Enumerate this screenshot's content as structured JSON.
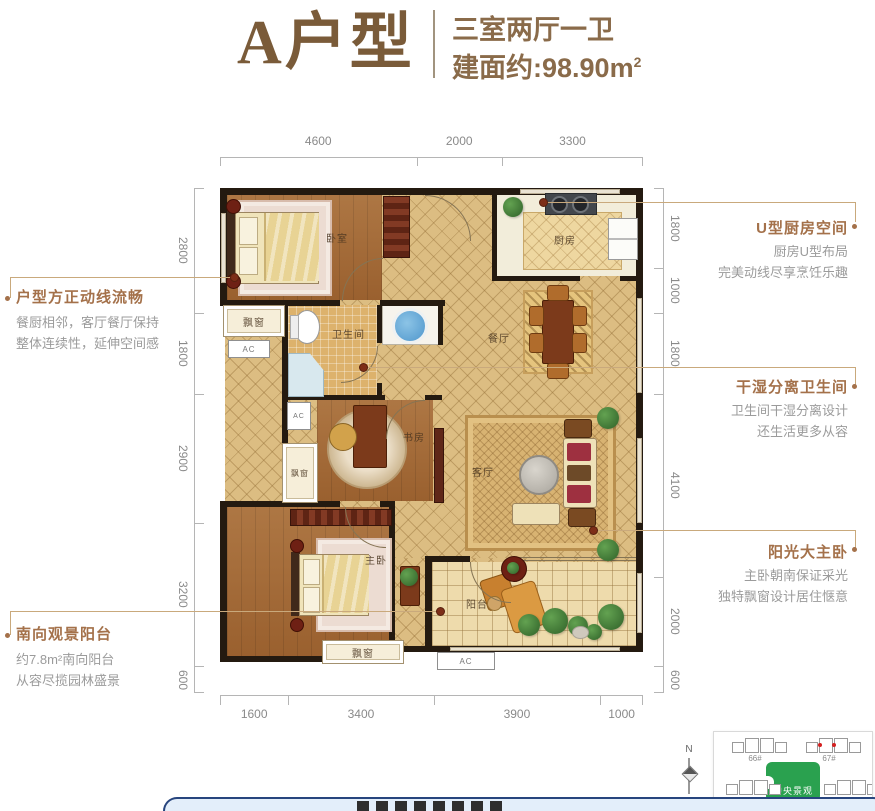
{
  "header": {
    "unit": "A户型",
    "layout": "三室两厅一卫",
    "area_label": "建面约:",
    "area_value": "98.90m",
    "area_sup": "2"
  },
  "dimensions": {
    "top": [
      "4600",
      "2000",
      "3300"
    ],
    "bottom": [
      "1600",
      "3400",
      "3900",
      "1000"
    ],
    "left": [
      "2800",
      "1800",
      "2900",
      "3200",
      "600"
    ],
    "right": [
      "1800",
      "1000",
      "1800",
      "4100",
      "2000",
      "600"
    ]
  },
  "annotations": {
    "left": [
      {
        "title": "户型方正动线流畅",
        "line1": "餐厨相邻，客厅餐厅保持",
        "line2": "整体连续性，延伸空间感"
      },
      {
        "title": "南向观景阳台",
        "line1": "约7.8m²南向阳台",
        "line2": "从容尽揽园林盛景"
      }
    ],
    "right": [
      {
        "title": "U型厨房空间",
        "line1": "厨房U型布局",
        "line2": "完美动线尽享烹饪乐趣"
      },
      {
        "title": "干湿分离卫生间",
        "line1": "卫生间干湿分离设计",
        "line2": "还生活更多从容"
      },
      {
        "title": "阳光大主卧",
        "line1": "主卧朝南保证采光",
        "line2": "独特飘窗设计居住惬意"
      }
    ]
  },
  "rooms": {
    "bedroom": "卧室",
    "kitchen": "厨房",
    "bathroom": "卫生间",
    "dining": "餐厅",
    "study": "书房",
    "living": "客厅",
    "master": "主卧",
    "balcony": "阳台",
    "bay_window": "飘窗",
    "ac": "AC"
  },
  "site_plan": {
    "building_66": "66#",
    "building_67": "67#",
    "center": "中央景观"
  },
  "compass": {
    "label": "N"
  },
  "colors": {
    "accent": "#a4714a",
    "leader": "#c9a97c",
    "wall": "#241a10",
    "header_brown": "#8a6b4a",
    "serif_brown": "#7a5b39",
    "dim_text": "#8a8a8a",
    "dim_line": "#b5b5b5",
    "body_gray": "#9b9b9b",
    "map_green": "#2aa14f",
    "bar_navy": "#27457e",
    "bar_fill": "#e3eefa"
  }
}
